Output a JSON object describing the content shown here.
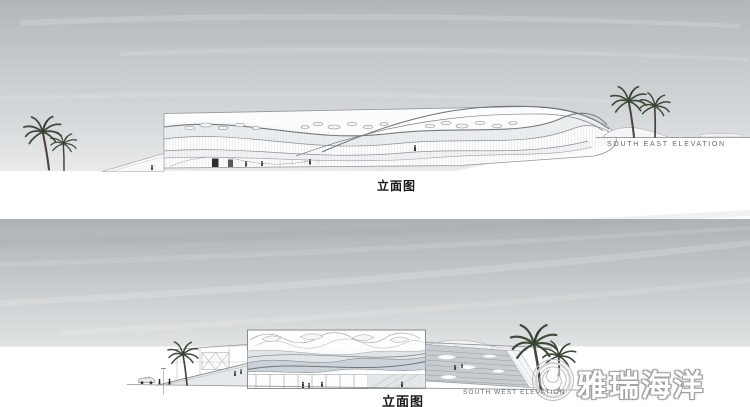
{
  "board": {
    "panels": [
      {
        "id": "south-east",
        "label_cn": "立面图",
        "caption_en": "SOUTH EAST ELEVATION"
      },
      {
        "id": "south-west",
        "label_cn": "立面图",
        "caption_en": "SOUTH WEST ELEVATION"
      }
    ],
    "watermark": {
      "text": "雅瑞海洋",
      "icon": "wave-circle-logo"
    },
    "colors": {
      "background": "#ffffff",
      "sky_dark": "#b0b4b6",
      "sky_light": "#e7e9ea",
      "drawing_line": "#7d8387",
      "glazing_band": "#ccd4d9",
      "palm_green": "#3e4b39",
      "palm_trunk": "#4c443c",
      "label_text": "#191919",
      "caption_text": "#64686b",
      "watermark_fill": "#ffffff",
      "watermark_outline": "#a2a2a2"
    }
  }
}
